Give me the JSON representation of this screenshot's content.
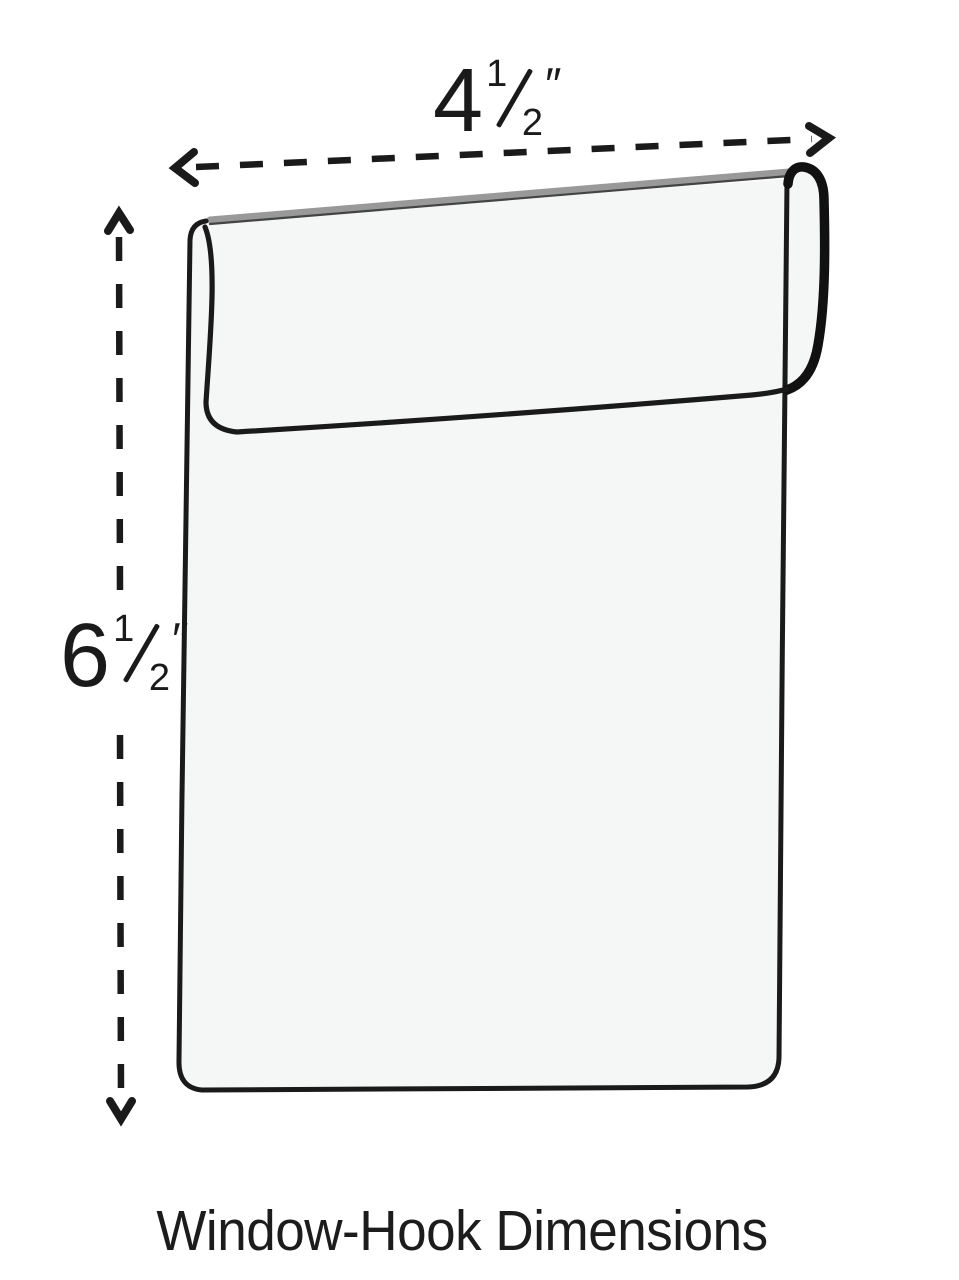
{
  "page": {
    "background_color": "#ffffff"
  },
  "caption": {
    "text": "Window-Hook Dimensions"
  },
  "dimensions": {
    "width": {
      "label": "4½″",
      "whole": "4",
      "numerator": "1",
      "denominator": "2",
      "unit": "″"
    },
    "height": {
      "label": "6½″",
      "whole": "6",
      "numerator": "1",
      "denominator": "2",
      "unit": "″"
    }
  },
  "diagram": {
    "object": "window-hook sign holder",
    "line_color": "#1a1a1a",
    "loop_color": "#111111",
    "fill_color": "#f5f6f6",
    "fold_edge_color": "#999999",
    "fold_shadow_color": "#444444"
  }
}
